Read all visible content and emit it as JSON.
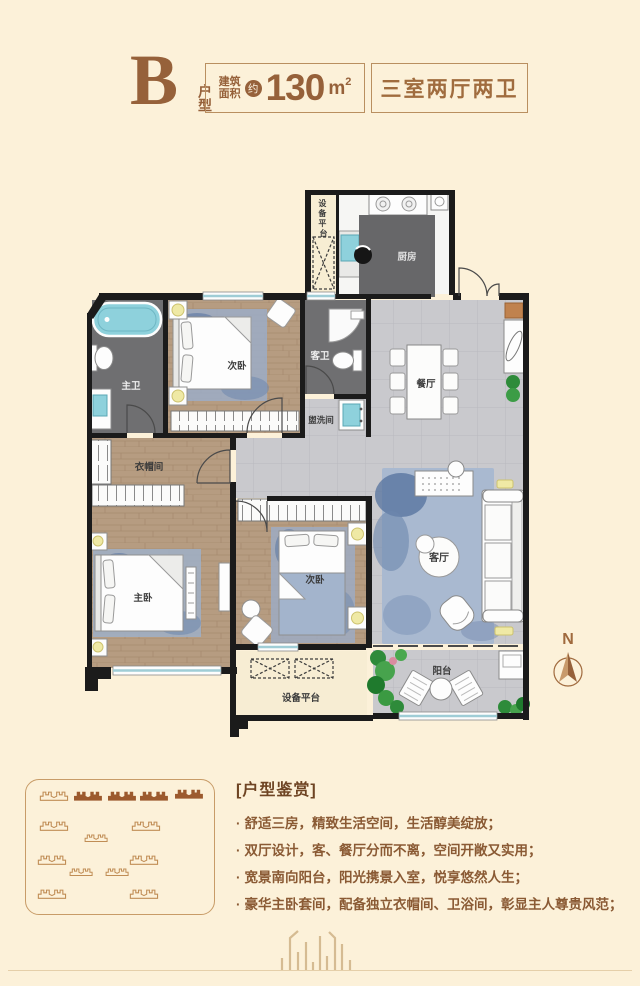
{
  "header": {
    "letter": "B",
    "letter_caption": "户型",
    "area_label_top": "建筑",
    "area_label_bottom": "面积",
    "approx": "约",
    "area_number": "130",
    "area_unit": "m",
    "area_sup": "2",
    "rooms_summary": "三室两厅两卫"
  },
  "plan": {
    "compass": "N",
    "labels": {
      "equip_top_chars": [
        "设",
        "备",
        "平",
        "台"
      ],
      "kitchen": "厨房",
      "master_bath": "主卫",
      "bedroom_top": "次卧",
      "guest_bath": "客卫",
      "washroom": "盥洗间",
      "dining": "餐厅",
      "cloakroom": "衣帽间",
      "master_bedroom": "主卧",
      "bedroom_second": "次卧",
      "living": "客厅",
      "balcony": "阳台",
      "equip_bottom": "设备平台"
    }
  },
  "review": {
    "bracket_open": "[",
    "bracket_close": "]",
    "title": "户型鉴赏",
    "bullet": "·",
    "items": [
      "舒适三房，精致生活空间，生活醇美绽放；",
      "双厅设计，客、餐厅分而不离，空间开敞又实用；",
      "宽景南向阳台，阳光携景入室，悦享悠然人生；",
      "豪华主卧套间，配备独立衣帽间、卫浴间，彰显主人尊贵风范；"
    ]
  },
  "colors": {
    "background_cream": "#fcf1d9",
    "accent_brown": "#96613a",
    "text_brown": "#8a5a34",
    "wall_black": "#1b1b1b",
    "wood_floor": "#b69c81",
    "marble_gray": "#cacace",
    "dark_floor": "#6f6f71",
    "rug_blue": "#7d93b5",
    "fixture_teal": "#8ed1dc",
    "plant_green": "#2e8b3a",
    "lamp_yellow": "#efe9a5",
    "copper": "#c0824e",
    "deco_tan": "#c89c68"
  }
}
